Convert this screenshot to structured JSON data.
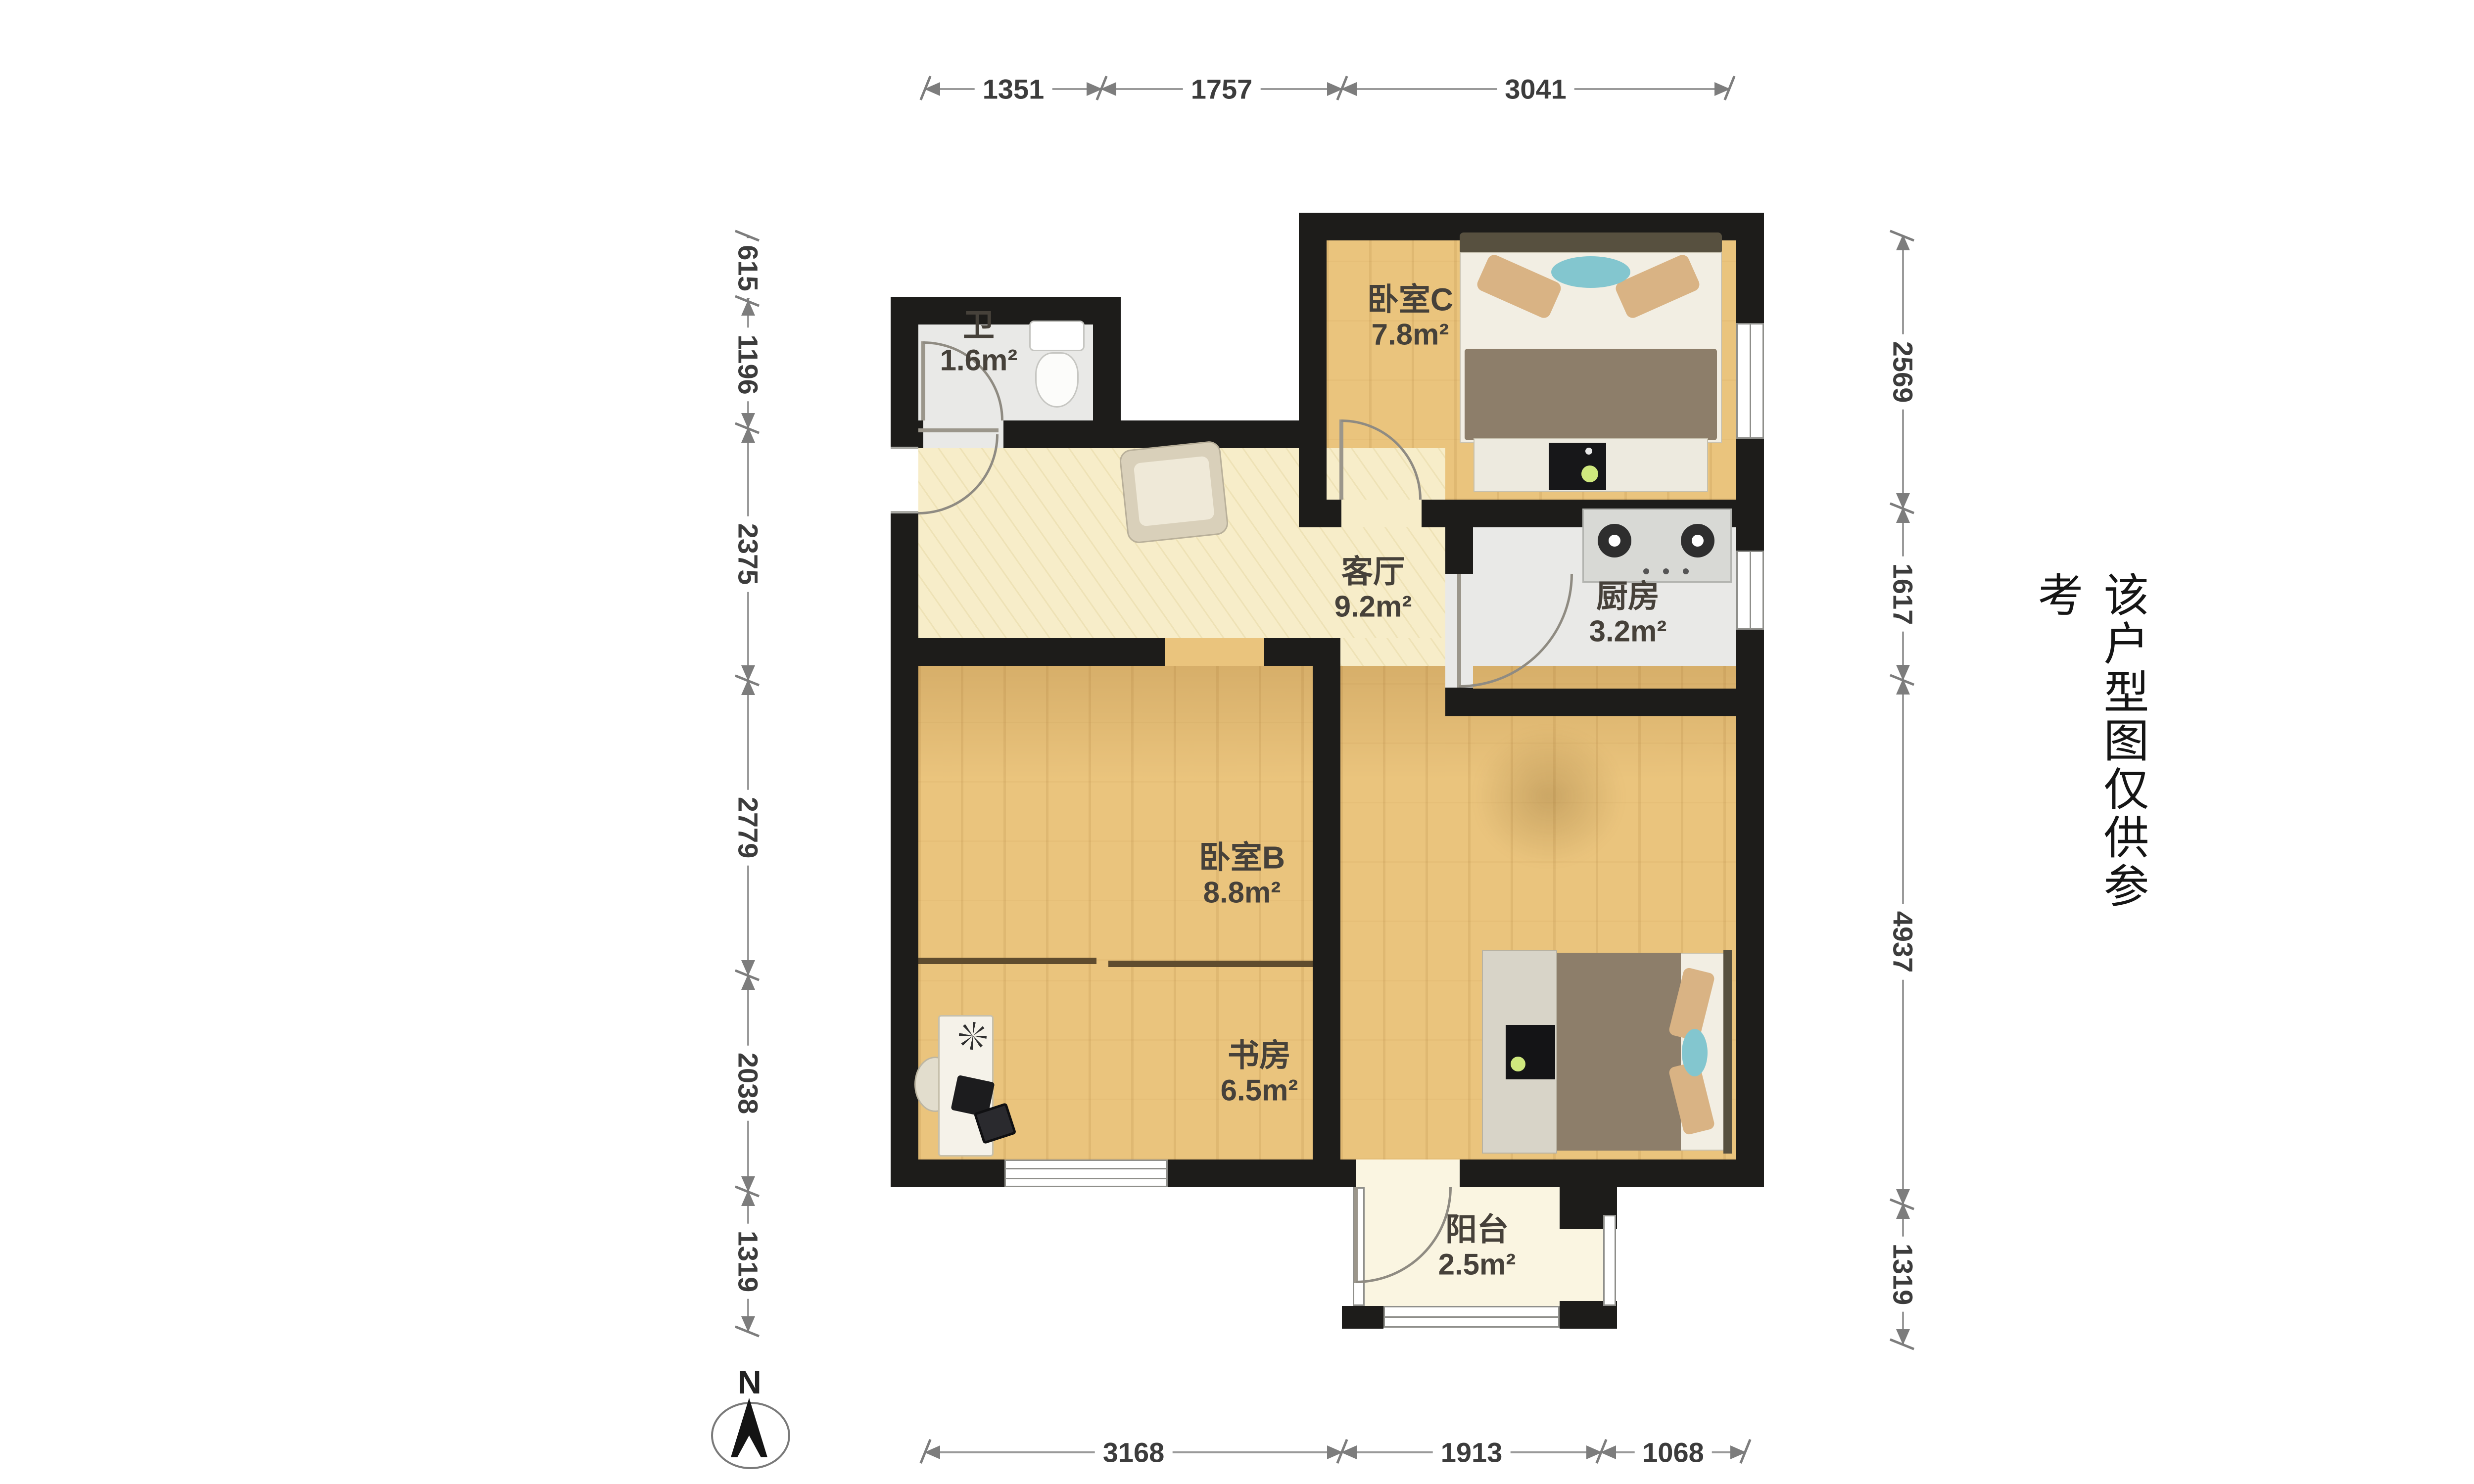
{
  "rooms": [
    {
      "name": "卧室C",
      "area": "7.8m²"
    },
    {
      "name": "卫",
      "area": "1.6m²"
    },
    {
      "name": "客厅",
      "area": "9.2m²"
    },
    {
      "name": "厨房",
      "area": "3.2m²"
    },
    {
      "name": "卧室B",
      "area": "8.8m²"
    },
    {
      "name": "书房",
      "area": "6.5m²"
    },
    {
      "name": "阳台",
      "area": "2.5m²"
    }
  ],
  "dimensions_mm": {
    "top": [
      "1351",
      "1757",
      "3041"
    ],
    "bottom": [
      "3168",
      "1913",
      "1068"
    ],
    "left": [
      "615",
      "1196",
      "2375",
      "2779",
      "2038",
      "1319"
    ],
    "right": [
      "2569",
      "1617",
      "4937",
      "1319"
    ]
  },
  "compass": {
    "label": "N"
  },
  "disclaimer": "该户型图仅供参考",
  "colors": {
    "wall": "#1d1c1a",
    "wood_floor": "#eac47d",
    "living_floor": "#f7edc9",
    "tile_floor": "#e9e9e7",
    "balcony_floor": "#faf5e1",
    "pillow_tan": "#d9b384",
    "accent_teal": "#83c6cf",
    "duvet_brown": "#8d7e6a"
  }
}
